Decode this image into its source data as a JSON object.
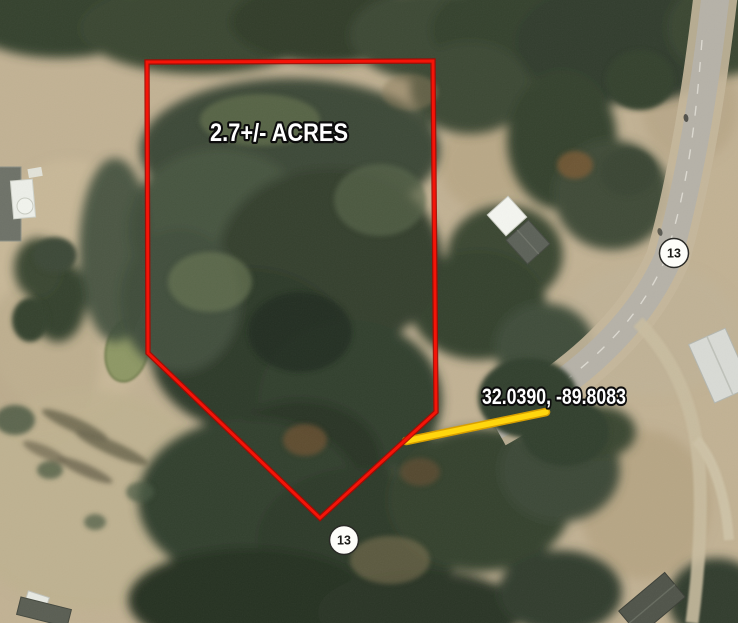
{
  "map": {
    "acreage_label": "2.7+/- ACRES",
    "coordinates_label": "32.0390, -89.8083",
    "boundary": {
      "points": "147,62 433,61 436,412 320,518 148,353",
      "stroke_color": "#f51408",
      "outline_color": "#a50a03"
    },
    "pin_line": {
      "path": "M406,441 L546,412",
      "color": "#ffd60e",
      "edge_color": "#d89f00"
    },
    "highway_shields": [
      {
        "number": "13"
      },
      {
        "number": "13"
      }
    ]
  }
}
